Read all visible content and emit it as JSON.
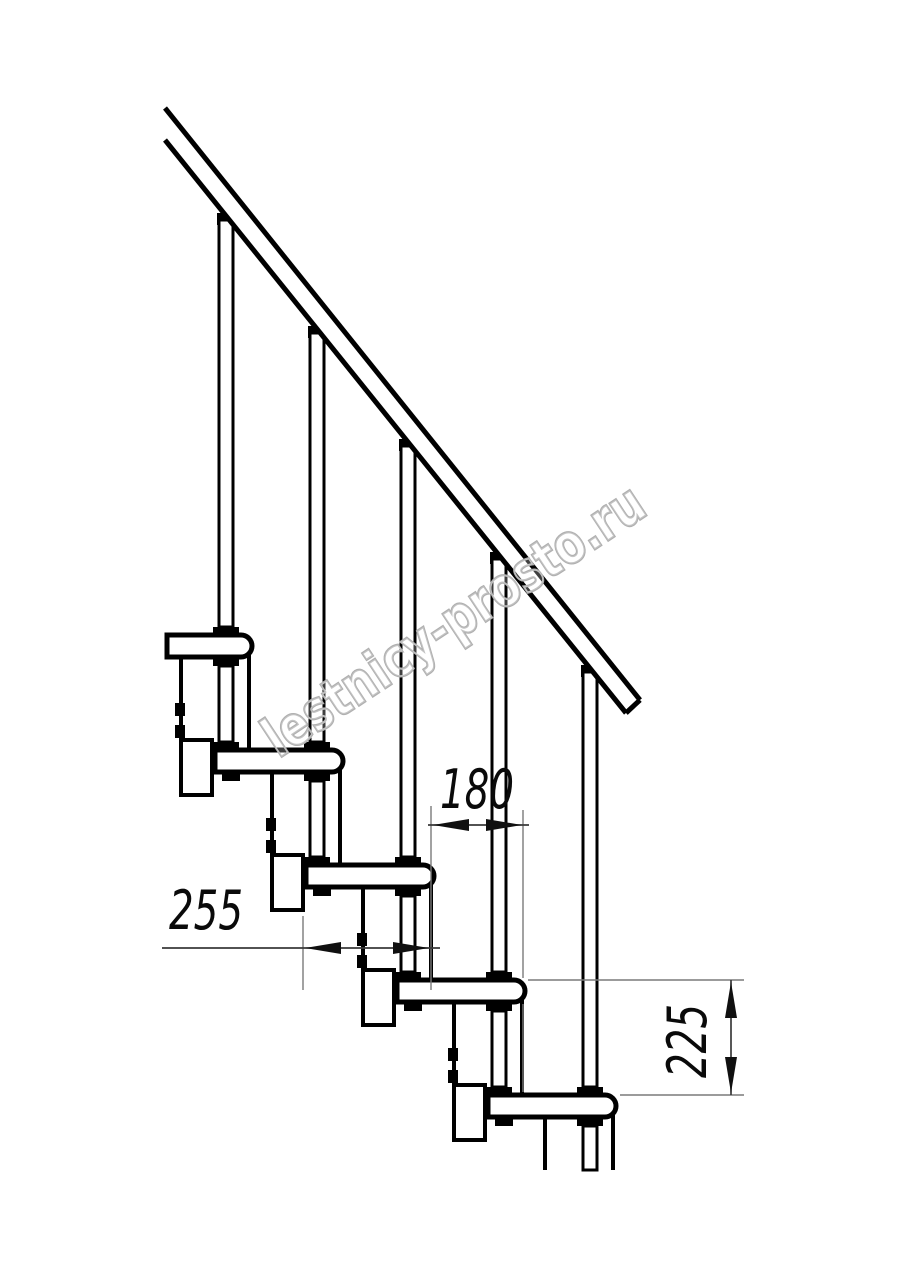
{
  "drawing": {
    "watermark": "lestnicy-prosto.ru",
    "dimensions": {
      "tread_depth": "255",
      "going": "180",
      "rise": "225"
    },
    "colors": {
      "line": "#000000",
      "dimension_line": "#3a3a3a",
      "extension_line": "#7a7a7a",
      "watermark_outline": "#b0b0b0",
      "background": "#ffffff"
    }
  }
}
